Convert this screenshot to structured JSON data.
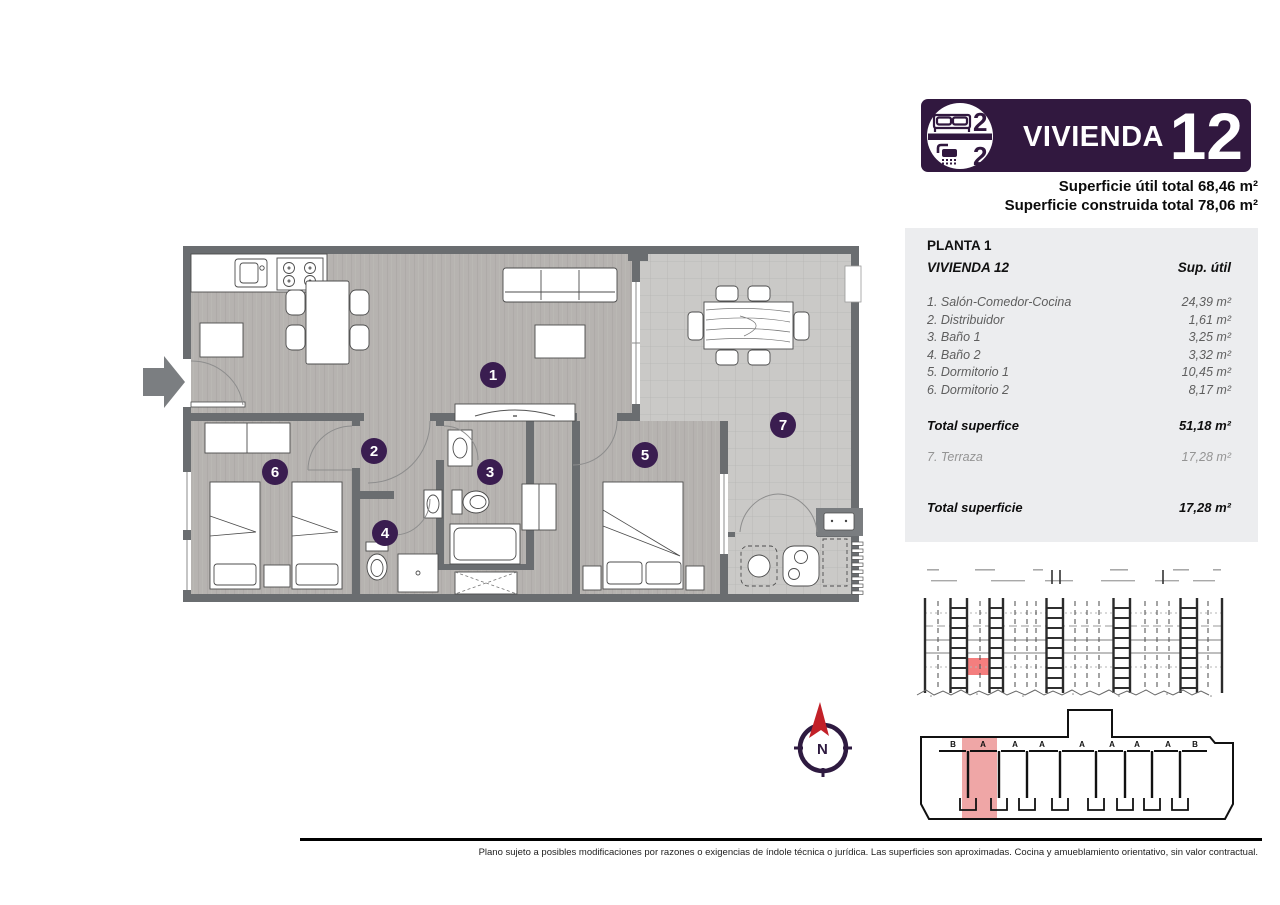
{
  "header": {
    "badge": {
      "title": "VIVIENDA",
      "number": "12",
      "bedrooms": "2",
      "bathrooms": "2"
    },
    "surface_util": "Superficie útil total 68,46 m²",
    "surface_built": "Superficie construida total 78,06 m²"
  },
  "panel": {
    "floor_label": "PLANTA 1",
    "unit_label": "VIVIENDA 12",
    "column_label": "Sup. útil",
    "rows": [
      {
        "label": "1. Salón-Comedor-Cocina",
        "value": "24,39 m²"
      },
      {
        "label": "2. Distribuidor",
        "value": "1,61 m²"
      },
      {
        "label": "3. Baño 1",
        "value": "3,25 m²"
      },
      {
        "label": "4. Baño 2",
        "value": "3,32 m²"
      },
      {
        "label": "5. Dormitorio 1",
        "value": "10,45 m²"
      },
      {
        "label": "6. Dormitorio 2",
        "value": "8,17 m²"
      }
    ],
    "subtotal": {
      "label": "Total superfice",
      "value": "51,18 m²"
    },
    "terrace": {
      "label": "7. Terraza",
      "value": "17,28 m²"
    },
    "total": {
      "label": "Total superficie",
      "value": "17,28 m²"
    }
  },
  "plan": {
    "rooms": [
      "1",
      "2",
      "3",
      "4",
      "5",
      "6",
      "7"
    ]
  },
  "keyplan": {
    "units": [
      "B",
      "A",
      "A",
      "A",
      "A",
      "A",
      "A",
      "A",
      "B"
    ]
  },
  "compass": {
    "north_label": "N"
  },
  "footer": {
    "disclaimer": "Plano sujeto a posibles modificaciones por razones o exigencias de índole técnica o jurídica. Las superficies son aproximadas. Cocina y amueblamiento orientativo, sin valor contractual."
  },
  "colors": {
    "brand_purple": "#31183f",
    "marker_purple": "#3a1d50",
    "highlight_red": "#f47e7e",
    "highlight_pink": "#efa6a6",
    "wall_gray": "#6a6d70",
    "floor_gray": "#b6b3b0",
    "terrace_gray": "#cac9c7"
  }
}
